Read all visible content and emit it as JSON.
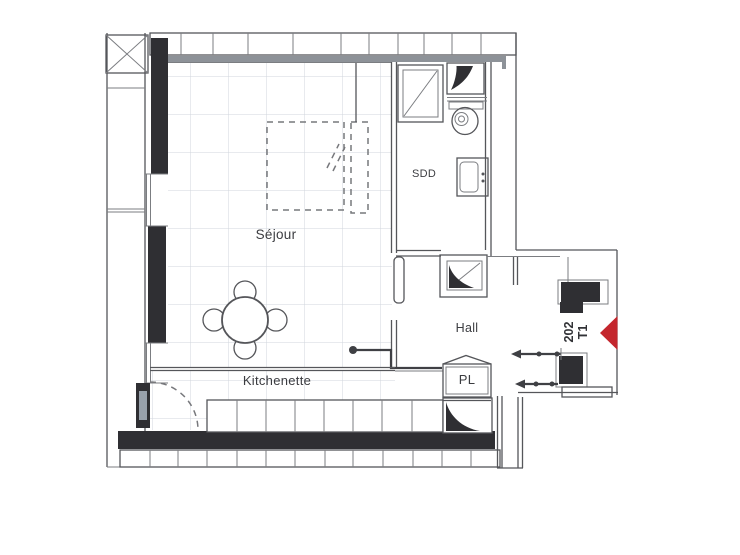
{
  "plan": {
    "unit_number": "202",
    "unit_type": "T1",
    "rooms": {
      "sejour": "Séjour",
      "sdd": "SDD",
      "hall": "Hall",
      "pl": "PL",
      "kitchenette": "Kitchenette"
    },
    "colors": {
      "entrance_marker_red": "#c4262d",
      "wall_fill_dark": "#2f2f33",
      "wall_line_gray": "#55565a",
      "floor_grid_gray": "#d0d5dc"
    }
  }
}
